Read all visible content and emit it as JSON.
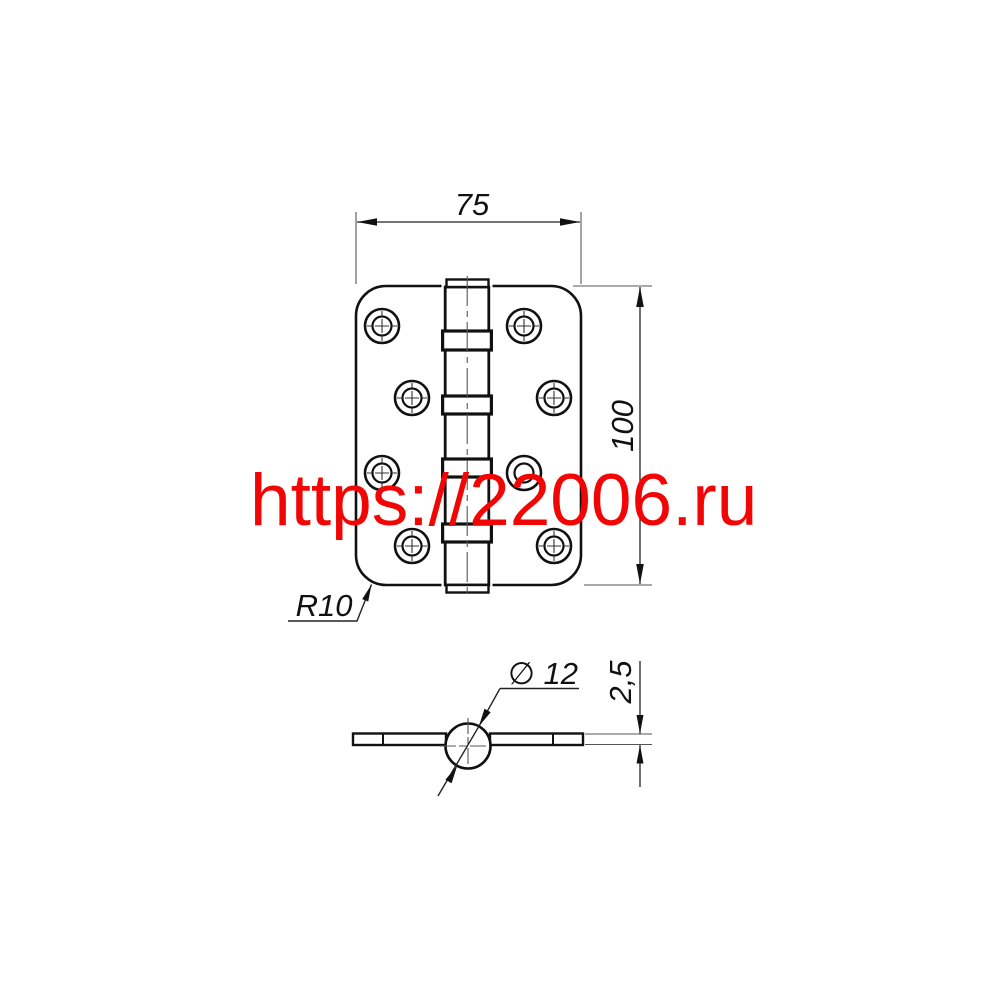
{
  "watermark": {
    "text": "https://22006.ru",
    "color": "#f20505"
  },
  "dimensions": {
    "plate_width": "75",
    "plate_height": "100",
    "corner_radius": "R10",
    "barrel_diameter": "∅ 12",
    "leaf_thickness": "2,5"
  },
  "drawing": {
    "object_line_color": "#111111",
    "thin_line_color": "#555555"
  }
}
